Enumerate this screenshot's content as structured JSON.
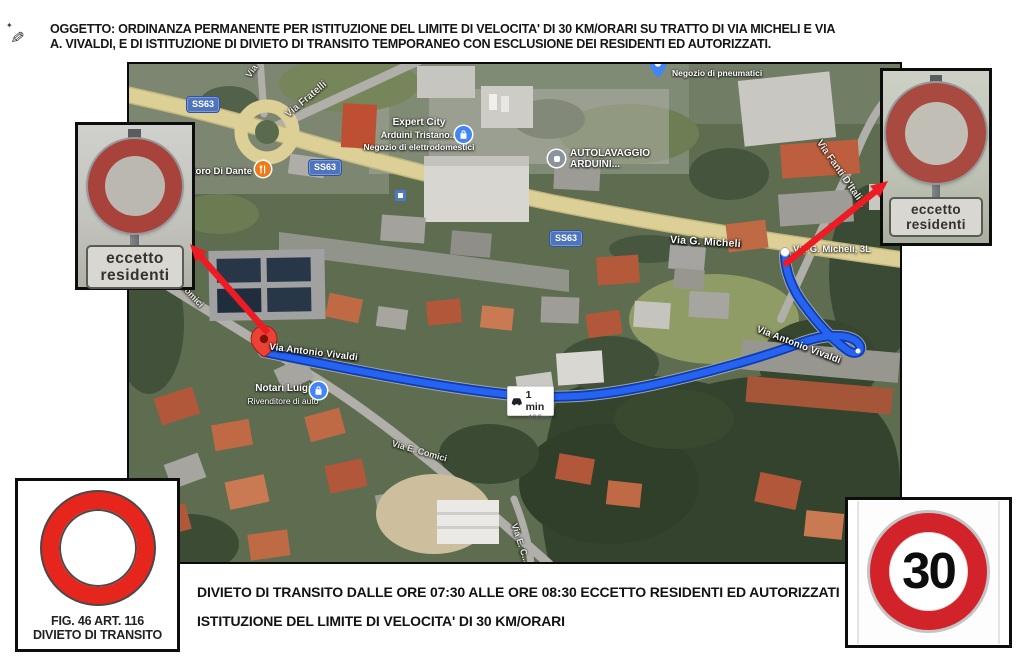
{
  "header": {
    "oggetto_line1": "OGGETTO: ORDINANZA PERMANENTE PER ISTITUZIONE DEL LIMITE DI VELOCITA' DI 30 KM/ORARI SU TRATTO DI VIA MICHELI E VIA",
    "oggetto_line2": "A. VIVALDI, E DI ISTITUZIONE DI DIVIETO DI TRANSITO TEMPORANEO CON ESCLUSIONE DEI RESIDENTI ED AUTORIZZATI."
  },
  "map": {
    "road_badges": {
      "ss63": "SS63"
    },
    "streets": {
      "via_fratelli": "Via Fratelli",
      "via_short": "Via",
      "via_g_micheli": "Via G. Micheli",
      "via_fanti": "Via Fanti D'Itali...",
      "comici": "Comici",
      "via_antonio_vivaldi": "Via Antonio Vivaldi",
      "via_e_comici": "Via E. Comici",
      "via_e_c": "Via E. C..."
    },
    "pois": {
      "negozio_pneumatici": "Negozio di pneumatici",
      "expert_city_line1": "Expert City",
      "expert_city_line2": "Arduini Tristano...",
      "expert_city_line3": "Negozio di elettrodomestici",
      "autolavaggio_line1": "AUTOLAVAGGIO",
      "autolavaggio_line2": "ARDUINI...",
      "ristoro": "...toro Di Dante",
      "notari_line1": "Notari Luigi",
      "notari_line2": "Rivenditore di auto",
      "micheli_3l": "Via G. Micheli, 3L"
    },
    "route_badge": {
      "duration": "1 min",
      "distance": "400m"
    }
  },
  "signs": {
    "left_photo": {
      "plaque_line1": "eccetto",
      "plaque_line2": "residenti"
    },
    "right_photo": {
      "plaque_line1": "eccetto",
      "plaque_line2": "residenti"
    },
    "fig": {
      "caption_line1": "FIG. 46 ART. 116",
      "caption_line2": "DIVIETO DI TRANSITO"
    },
    "speed_limit": {
      "value": "30"
    }
  },
  "footer": {
    "line1": "DIVIETO DI TRANSITO DALLE ORE 07:30 ALLE ORE 08:30 ECCETTO RESIDENTI ED AUTORIZZATI",
    "line2": "ISTITUZIONE DEL LIMITE DI VELOCITA' DI 30 KM/ORARI"
  },
  "colors": {
    "route_blue": "#2563f0",
    "arrow_red": "#ed1b24",
    "sign_red": "#d2232a",
    "road_tan": "#ddd096",
    "badge_blue": "#4d74bd"
  }
}
